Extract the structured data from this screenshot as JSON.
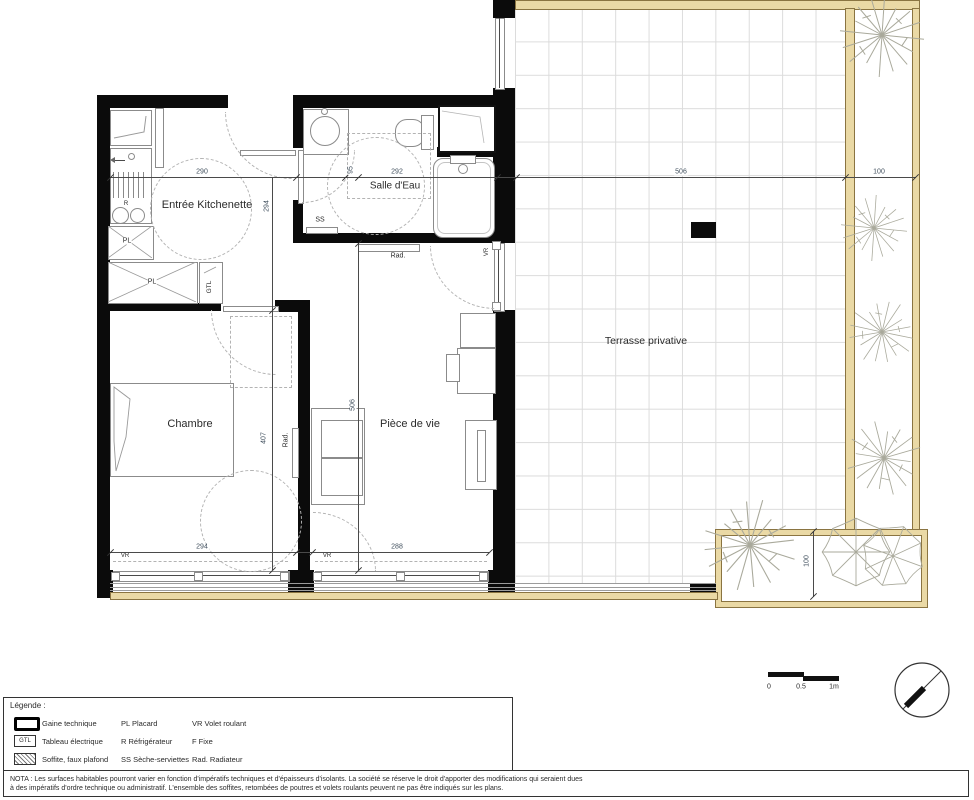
{
  "plan": {
    "room_labels": {
      "entree": "Entrée Kitchenette",
      "salle_eau": "Salle d'Eau",
      "chambre": "Chambre",
      "piece_de_vie": "Pièce de vie",
      "terrasse": "Terrasse privative"
    },
    "tags": {
      "pl": "PL",
      "gtl": "GTL",
      "ss": "SS",
      "rad": "Rad.",
      "vr": "VR",
      "r": "R"
    },
    "dims": {
      "d290": "290",
      "d292": "292",
      "d95": "95",
      "d294": "294",
      "d407": "407",
      "d506": "506",
      "d288": "288",
      "d100": "100"
    }
  },
  "scale_bar": {
    "zero": "0",
    "half": "0.5",
    "one": "1m"
  },
  "legend": {
    "title": "Légende :",
    "gtl_box": "GTL",
    "rows": [
      {
        "c1": "Gaine technique",
        "c2": "PL  Placard",
        "c3": "VR Volet roulant"
      },
      {
        "c1": "Tableau électrique",
        "c2": "R Réfrigérateur",
        "c3": "F Fixe"
      },
      {
        "c1": "Soffite, faux plafond",
        "c2": "SS Sèche-serviettes",
        "c3": "Rad. Radiateur"
      }
    ]
  },
  "nota": {
    "line1": "NOTA : Les surfaces habitables pourront varier en fonction d'impératifs techniques et d'épaisseurs d'isolants. La société se réserve le droit d'apporter des modifications qui seraient dues",
    "line2": "à des impératifs d'ordre technique ou administratif. L'ensemble des soffites, retombées de poutres et volets roulants peuvent ne pas être indiqués sur les plans."
  },
  "colors": {
    "wall": "#0b0b0b",
    "wood_fill": "#ead9a5",
    "wood_edge": "#8a7441",
    "tile_line": "#dcdcdc",
    "dash": "#b3b3b3",
    "ink": "#2b2b2b"
  }
}
